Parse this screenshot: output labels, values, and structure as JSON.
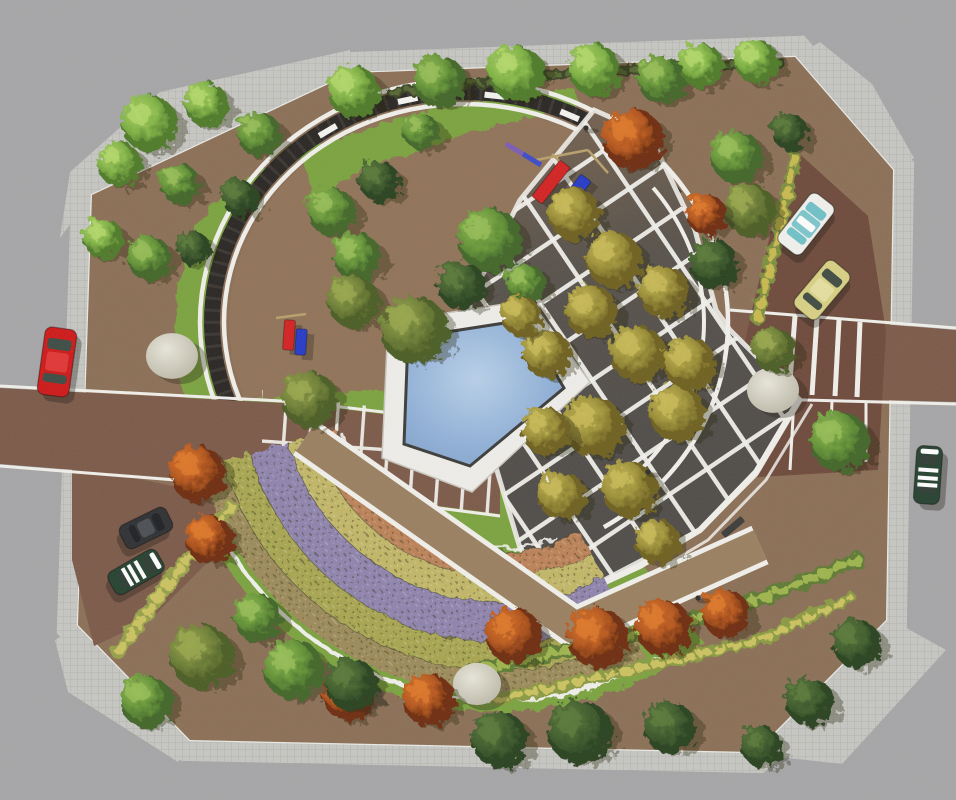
{
  "scene": {
    "kind": "aerial-landscape-masterplan-rendering",
    "canvas": {
      "w": 956,
      "h": 800
    },
    "description": "Top-down architectural rendering of a circular pocket park: pergola ring, pentagonal pool, diamond-grid bosque plaza, concentric flower parterres, lawns, street parking with cars"
  },
  "palette": {
    "street": "#a6a6a8",
    "sidewalk": "#c7c7c3",
    "sidewalk_line": "#b2b2ae",
    "curb": "#ebebe7",
    "ground": "#8b6e55",
    "ground_inner": "#95765a",
    "lawn": "#7aa33d",
    "road": "#7b5847",
    "parking": "#6d4839",
    "white_path": "#f2f1ec",
    "ring_dark": "#262321",
    "plaza_top": "#73604e",
    "plaza_dark": "#4e4a47",
    "walkway": "#9a7f5f",
    "pool_deck": "#f0efeb",
    "pool_rim": "#3a3a38",
    "water_hi": "#b9d1eb",
    "water": "#8fb0d8",
    "water_lo": "#7e9dc7",
    "boulder_hi": "#eae8dc",
    "boulder_lo": "#b7b4a2",
    "bench_dark": "#3a3a38"
  },
  "site": {
    "outline": [
      [
        352,
        73
      ],
      [
        795,
        57
      ],
      [
        893,
        170
      ],
      [
        886,
        620
      ],
      [
        755,
        752
      ],
      [
        190,
        740
      ],
      [
        78,
        625
      ],
      [
        92,
        195
      ]
    ],
    "sidewalk_width": 42,
    "aprons": [
      [
        [
          60,
          238
        ],
        [
          70,
          172
        ],
        [
          160,
          92
        ],
        [
          350,
          50
        ],
        [
          352,
          73
        ],
        [
          92,
          195
        ]
      ],
      [
        [
          795,
          57
        ],
        [
          893,
          170
        ],
        [
          914,
          158
        ],
        [
          872,
          84
        ],
        [
          820,
          42
        ]
      ],
      [
        [
          885,
          616
        ],
        [
          946,
          650
        ],
        [
          842,
          764
        ],
        [
          752,
          754
        ]
      ],
      [
        [
          55,
          640
        ],
        [
          78,
          625
        ],
        [
          190,
          740
        ],
        [
          178,
          762
        ],
        [
          68,
          692
        ]
      ]
    ],
    "inner_ellipse": {
      "cx": 464,
      "cy": 322,
      "rx": 235,
      "ry": 215
    }
  },
  "lawn": {
    "top_band": [
      [
        298,
        152
      ],
      [
        420,
        112
      ],
      [
        520,
        94
      ],
      [
        574,
        88
      ],
      [
        580,
        106
      ],
      [
        470,
        132
      ],
      [
        360,
        172
      ],
      [
        316,
        200
      ]
    ],
    "west_wedge": [
      [
        268,
        168
      ],
      [
        247,
        205
      ],
      [
        228,
        248
      ],
      [
        215,
        295
      ],
      [
        212,
        330
      ],
      [
        218,
        372
      ],
      [
        233,
        412
      ],
      [
        252,
        444
      ],
      [
        196,
        432
      ],
      [
        174,
        362
      ],
      [
        177,
        290
      ],
      [
        196,
        224
      ],
      [
        232,
        184
      ]
    ],
    "south_sector": {
      "cx": 500,
      "cy": 382,
      "r": 330,
      "a0": 52,
      "a1": 176
    }
  },
  "ring": {
    "cx": 464,
    "cy": 322,
    "rx": 252,
    "ry": 230,
    "rim_offset": 12,
    "rim_width": 4.5,
    "band_width": 16,
    "dark_a0": 147,
    "dark_a1": 327,
    "right_rim_a0": 322,
    "right_rim_a1": 418,
    "bench_angles": [
      237,
      257,
      277,
      295,
      311
    ],
    "bench_size": [
      20,
      6
    ]
  },
  "roads": {
    "left": {
      "poly": [
        [
          0,
          388
        ],
        [
          300,
          404
        ],
        [
          500,
          428
        ],
        [
          500,
          514
        ],
        [
          300,
          488
        ],
        [
          0,
          464
        ]
      ],
      "edge_top": [
        [
          0,
          386
        ],
        [
          300,
          402
        ],
        [
          500,
          426
        ]
      ],
      "edge_bot": [
        [
          0,
          466
        ],
        [
          300,
          490
        ],
        [
          500,
          516
        ]
      ]
    },
    "entrance_grid": [
      [
        262,
        390
      ],
      [
        500,
        426
      ],
      [
        498,
        514
      ],
      [
        262,
        500
      ]
    ],
    "right": {
      "poly": [
        [
          730,
          312
        ],
        [
          956,
          330
        ],
        [
          956,
          402
        ],
        [
          730,
          396
        ]
      ],
      "edge_top": [
        [
          730,
          310
        ],
        [
          956,
          328
        ]
      ],
      "edge_bot": [
        [
          730,
          398
        ],
        [
          956,
          404
        ]
      ]
    },
    "parking": [
      [
        793,
        148
      ],
      [
        868,
        216
      ],
      [
        886,
        332
      ],
      [
        878,
        470
      ],
      [
        742,
        478
      ],
      [
        733,
        396
      ],
      [
        752,
        310
      ],
      [
        775,
        215
      ]
    ],
    "sw_drive": [
      [
        72,
        465
      ],
      [
        240,
        500
      ],
      [
        206,
        564
      ],
      [
        150,
        620
      ],
      [
        94,
        646
      ],
      [
        72,
        560
      ]
    ],
    "crosswalk": [
      [
        [
          795,
          316
        ],
        [
          789,
          394
        ]
      ],
      [
        [
          817,
          318
        ],
        [
          812,
          395
        ]
      ],
      [
        [
          839,
          320
        ],
        [
          835,
          396
        ]
      ],
      [
        [
          860,
          322
        ],
        [
          857,
          397
        ]
      ]
    ],
    "parking_lines": [
      [
        [
          757,
          400
        ],
        [
          751,
          474
        ]
      ],
      [
        [
          794,
          400
        ],
        [
          790,
          470
        ]
      ],
      [
        [
          832,
          400
        ],
        [
          830,
          466
        ]
      ],
      [
        [
          866,
          402
        ],
        [
          866,
          462
        ]
      ]
    ]
  },
  "plaza": {
    "poly": [
      [
        594,
        110
      ],
      [
        650,
        135
      ],
      [
        695,
        230
      ],
      [
        716,
        310
      ],
      [
        730,
        330
      ],
      [
        800,
        400
      ],
      [
        756,
        474
      ],
      [
        700,
        530
      ],
      [
        566,
        600
      ],
      [
        520,
        548
      ],
      [
        470,
        380
      ],
      [
        470,
        300
      ],
      [
        520,
        200
      ]
    ],
    "grid_cell": 46,
    "grid_rot": -34,
    "grid_line": 4.5,
    "promenade1": [
      [
        566,
        600
      ],
      [
        640,
        566
      ],
      [
        700,
        530
      ],
      [
        756,
        472
      ],
      [
        800,
        398
      ]
    ],
    "promenade2": [
      [
        574,
        612
      ],
      [
        648,
        576
      ],
      [
        708,
        540
      ],
      [
        766,
        480
      ],
      [
        812,
        404
      ]
    ]
  },
  "pool": {
    "deck": [
      [
        388,
        322
      ],
      [
        530,
        300
      ],
      [
        590,
        382
      ],
      [
        472,
        492
      ],
      [
        382,
        458
      ]
    ],
    "water": [
      [
        408,
        338
      ],
      [
        524,
        320
      ],
      [
        564,
        388
      ],
      [
        470,
        466
      ],
      [
        404,
        444
      ]
    ]
  },
  "flower_arcs": {
    "cx": 500,
    "cy": 382,
    "a0": 62,
    "a1": 164,
    "bands": [
      {
        "name": "tan",
        "r0": 312,
        "r1": 288,
        "color": "#9c8a58"
      },
      {
        "name": "yellow-green",
        "r0": 288,
        "r1": 260,
        "color": "#a8a64f"
      },
      {
        "name": "purple",
        "r0": 260,
        "r1": 220,
        "color": "#8f83ad"
      },
      {
        "name": "yellow",
        "r0": 220,
        "r1": 194,
        "color": "#c2b766"
      },
      {
        "name": "salmon",
        "r0": 194,
        "r1": 170,
        "color": "#bd8156"
      }
    ],
    "outer_edge": {
      "r": 318,
      "a0": 60,
      "a1": 152
    },
    "inner_edge": {
      "r": 166,
      "a0": 70,
      "a1": 162
    }
  },
  "walkway": {
    "pts": [
      [
        305,
        438
      ],
      [
        575,
        628
      ],
      [
        760,
        545
      ]
    ],
    "width": 32,
    "edge_width": 42
  },
  "hedges": [
    {
      "pts": [
        [
          795,
          158
        ],
        [
          775,
          245
        ],
        [
          757,
          318
        ]
      ],
      "w": 13,
      "base": "#7d8f3c",
      "dash": "#c9ba4e"
    },
    {
      "pts": [
        [
          468,
          672
        ],
        [
          600,
          643
        ],
        [
          730,
          610
        ],
        [
          858,
          560
        ]
      ],
      "w": 15,
      "base": "#5d7a33",
      "dash": "#9eb54b"
    },
    {
      "pts": [
        [
          498,
          700
        ],
        [
          640,
          668
        ],
        [
          760,
          640
        ],
        [
          850,
          598
        ]
      ],
      "w": 12,
      "base": "#8a9a3f",
      "dash": "#ccc35e"
    },
    {
      "pts": [
        [
          233,
          508
        ],
        [
          170,
          580
        ],
        [
          118,
          652
        ]
      ],
      "w": 14,
      "base": "#96a048",
      "dash": "#ccc35e"
    },
    {
      "pts": [
        [
          392,
          92
        ],
        [
          560,
          74
        ],
        [
          700,
          66
        ],
        [
          780,
          62
        ]
      ],
      "w": 10,
      "base": "#374322",
      "dash": "#556630"
    }
  ],
  "boulders": [
    [
      172,
      356,
      26
    ],
    [
      773,
      390,
      26
    ],
    [
      477,
      684,
      24
    ]
  ],
  "tree_palette": {
    "lg": {
      "base": "#4e7a28",
      "mid": "#7fb342",
      "hi": "#b4d96a"
    },
    "mg": {
      "base": "#3f6526",
      "mid": "#639434",
      "hi": "#97bf55"
    },
    "dg": {
      "base": "#26401d",
      "mid": "#3d5c2a",
      "hi": "#5a7a38"
    },
    "og": {
      "base": "#4a5c22",
      "mid": "#6d7f33",
      "hi": "#9aa84c"
    },
    "ol": {
      "base": "#6d5f1e",
      "mid": "#9c8f35",
      "hi": "#c9bb55"
    },
    "or": {
      "base": "#6e2c08",
      "mid": "#b5541a",
      "hi": "#e07828"
    }
  },
  "trees": [
    [
      148,
      122,
      28,
      "lg"
    ],
    [
      205,
      103,
      22,
      "lg"
    ],
    [
      118,
      163,
      22,
      "lg"
    ],
    [
      258,
      133,
      22,
      "mg"
    ],
    [
      178,
      182,
      20,
      "mg"
    ],
    [
      238,
      196,
      18,
      "dg"
    ],
    [
      102,
      237,
      20,
      "lg"
    ],
    [
      148,
      257,
      22,
      "mg"
    ],
    [
      192,
      247,
      17,
      "dg"
    ],
    [
      352,
      90,
      26,
      "lg"
    ],
    [
      438,
      80,
      26,
      "mg"
    ],
    [
      515,
      72,
      28,
      "lg"
    ],
    [
      420,
      130,
      18,
      "mg"
    ],
    [
      330,
      210,
      24,
      "mg"
    ],
    [
      378,
      180,
      20,
      "dg"
    ],
    [
      412,
      328,
      34,
      "og"
    ],
    [
      308,
      398,
      28,
      "og"
    ],
    [
      355,
      255,
      24,
      "mg"
    ],
    [
      352,
      300,
      26,
      "og"
    ],
    [
      488,
      238,
      32,
      "mg"
    ],
    [
      460,
      284,
      24,
      "dg"
    ],
    [
      524,
      282,
      20,
      "mg"
    ],
    [
      593,
      68,
      26,
      "lg"
    ],
    [
      660,
      78,
      24,
      "mg"
    ],
    [
      700,
      64,
      22,
      "lg"
    ],
    [
      755,
      60,
      22,
      "lg"
    ],
    [
      735,
      155,
      26,
      "mg"
    ],
    [
      788,
      130,
      18,
      "dg"
    ],
    [
      748,
      208,
      26,
      "og"
    ],
    [
      712,
      262,
      24,
      "dg"
    ],
    [
      772,
      348,
      22,
      "og"
    ],
    [
      838,
      440,
      30,
      "mg"
    ],
    [
      632,
      138,
      30,
      "or"
    ],
    [
      705,
      213,
      20,
      "or"
    ],
    [
      196,
      472,
      28,
      "or"
    ],
    [
      208,
      538,
      24,
      "or"
    ],
    [
      512,
      634,
      28,
      "or"
    ],
    [
      596,
      636,
      30,
      "or"
    ],
    [
      662,
      626,
      28,
      "or"
    ],
    [
      724,
      612,
      24,
      "or"
    ],
    [
      347,
      693,
      26,
      "or"
    ],
    [
      427,
      698,
      26,
      "or"
    ],
    [
      572,
      212,
      26,
      "ol"
    ],
    [
      612,
      258,
      28,
      "ol"
    ],
    [
      662,
      290,
      26,
      "ol"
    ],
    [
      590,
      310,
      26,
      "ol"
    ],
    [
      545,
      352,
      24,
      "ol"
    ],
    [
      636,
      352,
      28,
      "ol"
    ],
    [
      688,
      362,
      26,
      "ol"
    ],
    [
      592,
      425,
      30,
      "ol"
    ],
    [
      676,
      412,
      28,
      "ol"
    ],
    [
      628,
      488,
      28,
      "ol"
    ],
    [
      560,
      494,
      24,
      "ol"
    ],
    [
      656,
      540,
      22,
      "ol"
    ],
    [
      545,
      430,
      24,
      "ol"
    ],
    [
      520,
      315,
      20,
      "ol"
    ],
    [
      145,
      700,
      26,
      "mg"
    ],
    [
      200,
      655,
      32,
      "og"
    ],
    [
      256,
      616,
      24,
      "mg"
    ],
    [
      292,
      668,
      30,
      "mg"
    ],
    [
      350,
      683,
      26,
      "dg"
    ],
    [
      498,
      738,
      28,
      "dg"
    ],
    [
      578,
      730,
      32,
      "dg"
    ],
    [
      668,
      726,
      26,
      "dg"
    ],
    [
      808,
      700,
      24,
      "dg"
    ],
    [
      855,
      642,
      24,
      "dg"
    ],
    [
      760,
      745,
      20,
      "dg"
    ]
  ],
  "cars": [
    {
      "name": "car-red",
      "x": 57,
      "y": 362,
      "rot": 8,
      "len": 68,
      "wid": 32,
      "body": "#cf1616",
      "roof": "#e23434",
      "win": "#3a4a42",
      "style": "sedan"
    },
    {
      "name": "car-white",
      "x": 806,
      "y": 224,
      "rot": 38,
      "len": 62,
      "wid": 30,
      "body": "#f2f2ee",
      "roof": "#ffffff",
      "win": "#6fc2c9",
      "style": "teal"
    },
    {
      "name": "car-yellow",
      "x": 822,
      "y": 290,
      "rot": 40,
      "len": 60,
      "wid": 30,
      "body": "#d9d184",
      "roof": "#e6e0a0",
      "win": "#3f4a40",
      "style": "sedan"
    },
    {
      "name": "car-green-east",
      "x": 928,
      "y": 475,
      "rot": 4,
      "len": 58,
      "wid": 26,
      "body": "#24402e",
      "roof": "#ffffff",
      "win": "#2e3b33",
      "style": "striped"
    },
    {
      "name": "car-black",
      "x": 146,
      "y": 528,
      "rot": 64,
      "len": 52,
      "wid": 26,
      "body": "#2c2e31",
      "roof": "#4a4d52",
      "win": "#1c1e22",
      "style": "sedan"
    },
    {
      "name": "car-green-west",
      "x": 136,
      "y": 572,
      "rot": 60,
      "len": 56,
      "wid": 26,
      "body": "#24402e",
      "roof": "#ffffff",
      "win": "#2c3a31",
      "style": "striped"
    }
  ],
  "playground": {
    "slides": [
      {
        "x": 551,
        "y": 182,
        "w": 13,
        "l": 46,
        "rot": 38,
        "color": "#d42020"
      },
      {
        "x": 572,
        "y": 196,
        "w": 13,
        "l": 46,
        "rot": 38,
        "color": "#2438c8"
      }
    ],
    "frames": [
      [
        536,
        160,
        588,
        150
      ],
      [
        588,
        150,
        608,
        173
      ],
      [
        552,
        154,
        568,
        170
      ],
      [
        276,
        318,
        306,
        314
      ]
    ],
    "seesaw": [
      [
        506,
        144,
        523,
        154,
        "#7a5bb5"
      ],
      [
        523,
        154,
        541,
        165,
        "#3b49c9"
      ]
    ],
    "towers": [
      {
        "x": 289,
        "y": 335,
        "w": 11,
        "l": 30,
        "rot": 4,
        "color": "#d42020"
      },
      {
        "x": 301,
        "y": 342,
        "w": 11,
        "l": 26,
        "rot": 4,
        "color": "#2438c8"
      }
    ]
  },
  "benches_dark": [
    [
      733,
      527,
      -40
    ]
  ],
  "lamps": [
    [
      648,
      472
    ],
    [
      698,
      598
    ],
    [
      586,
      128
    ]
  ]
}
